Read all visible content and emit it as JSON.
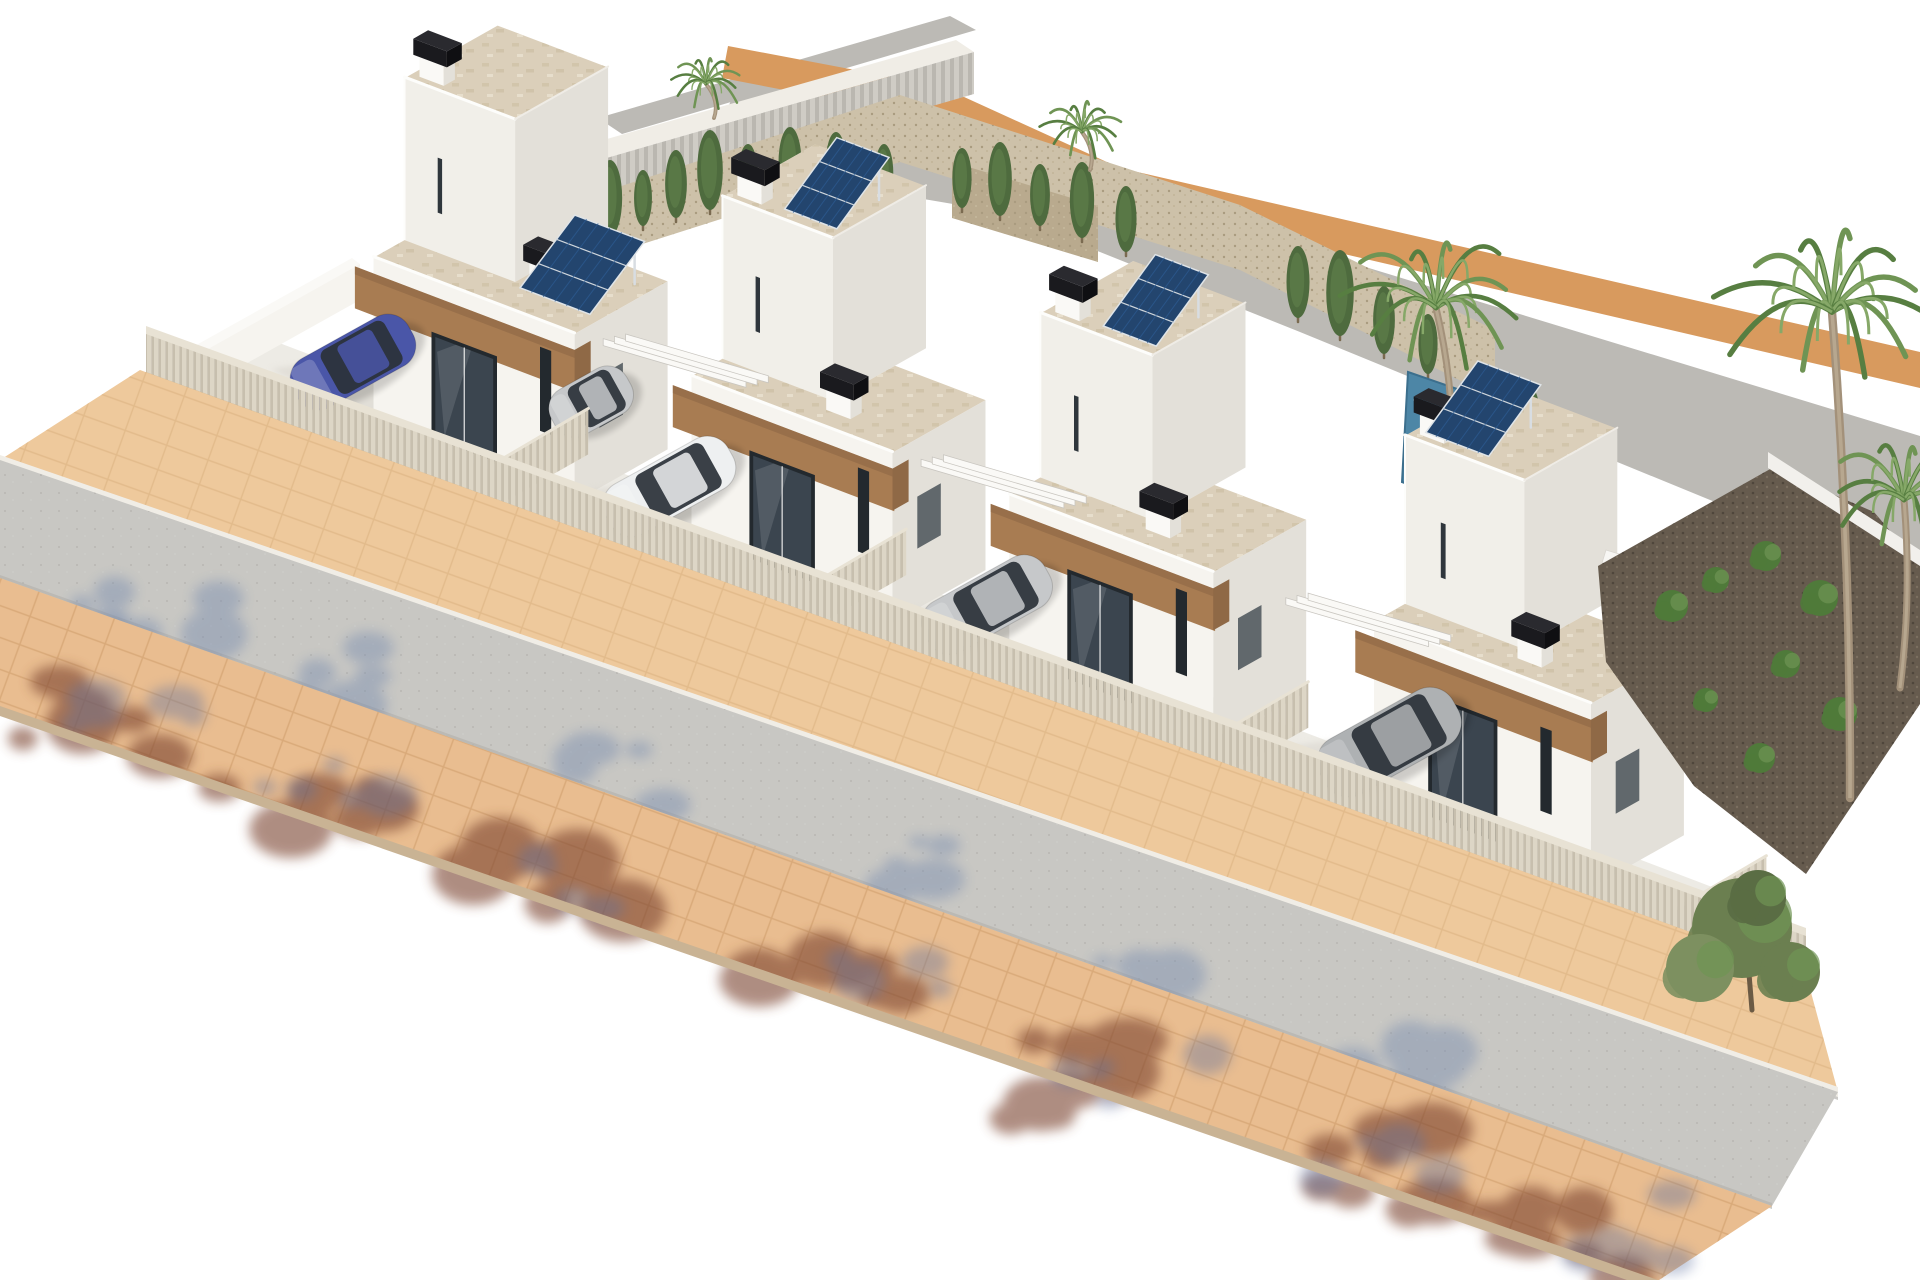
{
  "scene": {
    "type": "3d-architectural-render",
    "view": "aerial axonometric view from front-left",
    "setting": "new-build residential development of four modern white cubic villas with flat roofs, rooftop solar panels, walled driveways, a front street with tan paved sidewalks and tree shadows, a rear street with an orange curb, and palm-tree landscaping",
    "villa_count": 4
  },
  "palette": {
    "background": "#ffffff",
    "road": "#c8c7c3",
    "sidewalk": "#eec99c",
    "sidewalk_bottom": "#e9bd90",
    "paver_line": "#d9ae7e",
    "curb": "#f0ede6",
    "curb_line": "#a9a7a2",
    "slab_edge": "#c9b394",
    "rear_road": "#bcbab5",
    "rear_curb": "#d89a5e",
    "rear_wall": "#c6c3bc",
    "fence": "#d9d2c2",
    "fence_dark": "#c4bcab",
    "fence_shadow": "#b49a72",
    "wall_lit": "#faf9f6",
    "wall_face": "#f6f4ef",
    "wall_face_hi": "#f1efe9",
    "wall_shade": "#e3e0d9",
    "drive": "#edebe5",
    "drive_shadow": "#d6d2ca",
    "roof": "#dbcfba",
    "parapet": "#fdfdfb",
    "wood": "#a87c52",
    "wood_dark": "#8f6946",
    "window_frame": "#23292e",
    "window_glass": "#3b454f",
    "chimney": "#1a1a1e",
    "chimney_top": "#2a2a2f",
    "solar_panel": "#23456e",
    "solar_cell": "#2d5c94",
    "pool": "#4d86a6",
    "pool_light": "#7fb2c8",
    "gravel": "#cdc1a9",
    "gravel_dark": "#665b4e",
    "stone_planter": "#b9aa8e",
    "cypress": "#4e6b3e",
    "palm": "#6f9454",
    "palm_dark": "#577e41",
    "trunk": "#a3917a",
    "bush": "#4f7a3a",
    "olive": "#6b7f50",
    "shadow_blue": "#7388ad",
    "shadow_brown": "#7a422e",
    "shadow_canopy": "#5b6e9e",
    "car_blue": "#4a56a8",
    "car_white": "#eef0f1",
    "car_silver": "#c6c8ca",
    "car_grey": "#aeb1b3",
    "car_glass": "#2a3138"
  },
  "villas": [
    {
      "name": "villa-1",
      "solar_panels": 1,
      "chimneys": 2,
      "wood_balcony_fascia": true,
      "roof_finish": "beige stone pavers",
      "parked_car": "blue-hatchback"
    },
    {
      "name": "villa-2",
      "solar_panels": 1,
      "chimneys": 2,
      "wood_balcony_fascia": true,
      "roof_finish": "beige stone pavers",
      "parked_car": "white-car"
    },
    {
      "name": "villa-3",
      "solar_panels": 1,
      "chimneys": 2,
      "wood_balcony_fascia": true,
      "roof_finish": "beige stone pavers",
      "parked_car": "silver-car"
    },
    {
      "name": "villa-4",
      "solar_panels": 1,
      "chimneys": 2,
      "wood_balcony_fascia": true,
      "roof_finish": "beige stone pavers",
      "parked_car": "grey-suv",
      "external_side_stairs": true
    }
  ],
  "vehicles": [
    {
      "name": "blue-hatchback",
      "location": "villa-1 driveway",
      "color": "#4a56a8"
    },
    {
      "name": "silver-car-partial",
      "location": "between villa-1 and villa-2",
      "color": "#c6c8ca"
    },
    {
      "name": "white-car",
      "location": "villa-2 driveway",
      "color": "#eef0f1"
    },
    {
      "name": "silver-car",
      "location": "villa-3 driveway",
      "color": "#c6c8ca"
    },
    {
      "name": "grey-suv",
      "location": "villa-4 driveway",
      "color": "#aeb1b3"
    }
  ],
  "vegetation": {
    "palm_trees": 5,
    "cypress_trees": 21,
    "shrubs": 11,
    "gravel_beds": "beige gravel rear gardens and dark gravel side garden",
    "street_tree_shadows": "red-brown and blue foliage shadows cast on sidewalk and road"
  },
  "infrastructure": {
    "front_street": "grey asphalt running diagonally lower-left to lower-right",
    "sidewalks": "tan square pavers on both sides of the front street",
    "rear_street": "grey road with orange paver curb curving along the top",
    "fencing": "light slatted privacy fence along the front of all plots",
    "pool": "small pool between villa-3 and villa-4",
    "solar": "tilted rooftop photovoltaic arrays on every villa"
  }
}
